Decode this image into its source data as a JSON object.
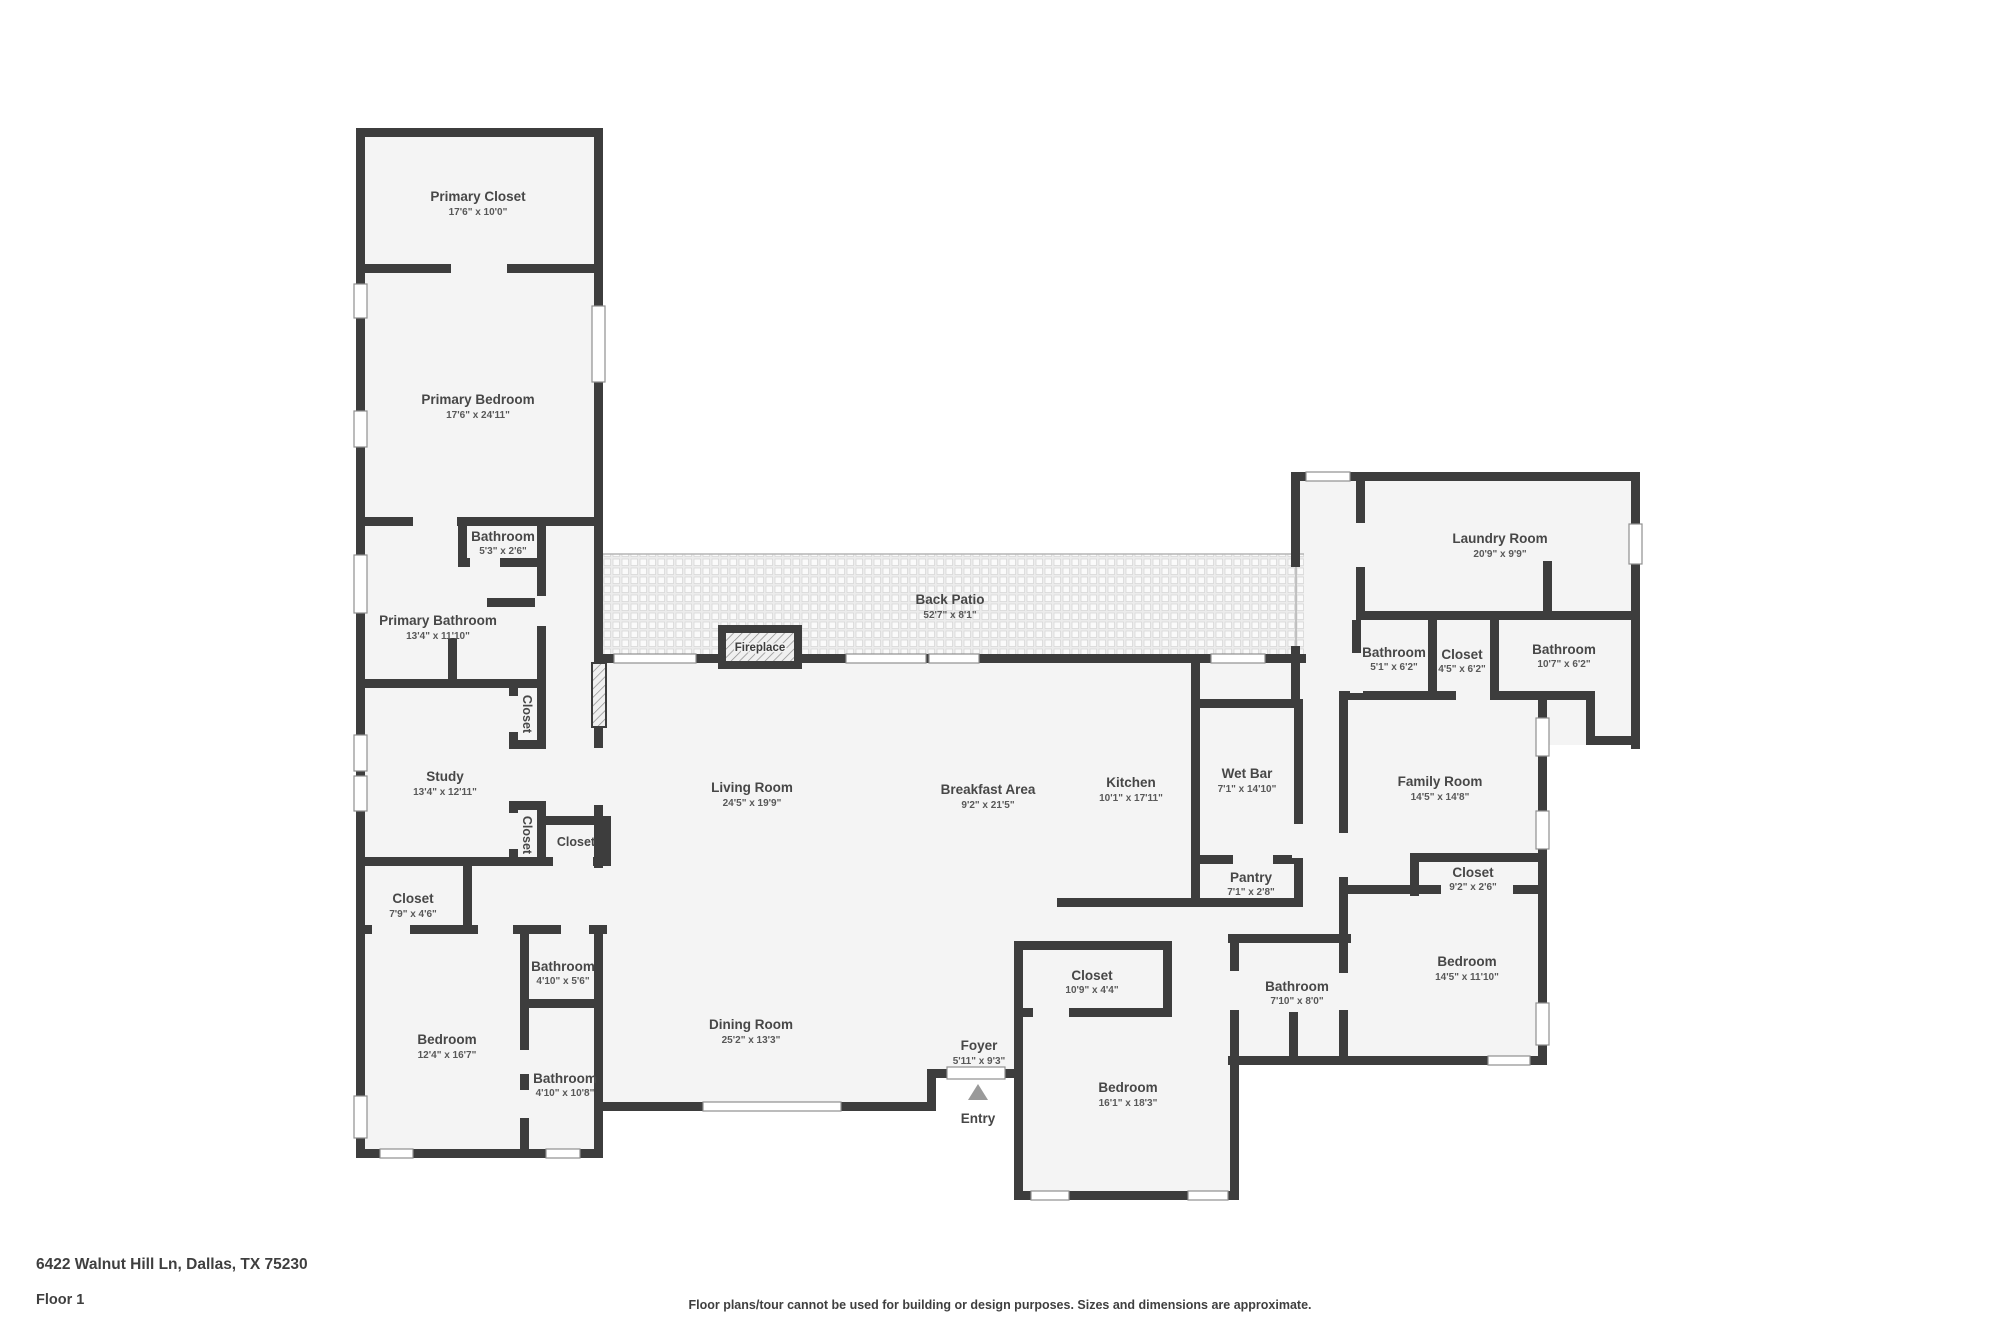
{
  "footer": {
    "address": "6422 Walnut Hill Ln, Dallas, TX 75230",
    "floor_label": "Floor 1",
    "disclaimer": "Floor plans/tour cannot be used for building or design purposes. Sizes and dimensions are approximate."
  },
  "markers": {
    "entry_label": "Entry",
    "fireplace_label": "Fireplace"
  },
  "colors": {
    "wall": "#3d3d3d",
    "room_fill": "#f4f4f4",
    "label_text": "#474747"
  },
  "rooms": {
    "primary_closet": {
      "name": "Primary Closet",
      "dims": "17'6\" x 10'0\""
    },
    "primary_bedroom": {
      "name": "Primary Bedroom",
      "dims": "17'6\" x 24'11\""
    },
    "bathroom_primary_small": {
      "name": "Bathroom",
      "dims": "5'3\" x 2'6\""
    },
    "primary_bathroom": {
      "name": "Primary Bathroom",
      "dims": "13'4\" x 11'10\""
    },
    "study": {
      "name": "Study",
      "dims": "13'4\" x 12'11\""
    },
    "closet_study_upper": {
      "name": "Closet",
      "dims": ""
    },
    "closet_study_lower": {
      "name": "Closet",
      "dims": ""
    },
    "closet_study_side": {
      "name": "Closet",
      "dims": ""
    },
    "closet_hall": {
      "name": "Closet",
      "dims": "7'9\" x 4'6\""
    },
    "bedroom_left": {
      "name": "Bedroom",
      "dims": "12'4\" x 16'7\""
    },
    "bathroom_left_upper": {
      "name": "Bathroom",
      "dims": "4'10\" x 5'6\""
    },
    "bathroom_left_lower": {
      "name": "Bathroom",
      "dims": "4'10\" x 10'8\""
    },
    "back_patio": {
      "name": "Back Patio",
      "dims": "52'7\" x 8'1\""
    },
    "living_room": {
      "name": "Living Room",
      "dims": "24'5\" x 19'9\""
    },
    "breakfast_area": {
      "name": "Breakfast Area",
      "dims": "9'2\" x 21'5\""
    },
    "kitchen": {
      "name": "Kitchen",
      "dims": "10'1\" x 17'11\""
    },
    "wet_bar": {
      "name": "Wet Bar",
      "dims": "7'1\" x 14'10\""
    },
    "pantry": {
      "name": "Pantry",
      "dims": "7'1\" x 2'8\""
    },
    "dining_room": {
      "name": "Dining Room",
      "dims": "25'2\" x 13'3\""
    },
    "foyer": {
      "name": "Foyer",
      "dims": "5'11\" x 9'3\""
    },
    "laundry_room": {
      "name": "Laundry Room",
      "dims": "20'9\" x 9'9\""
    },
    "bathroom_right_1": {
      "name": "Bathroom",
      "dims": "5'1\" x 6'2\""
    },
    "closet_right_1": {
      "name": "Closet",
      "dims": "4'5\" x 6'2\""
    },
    "bathroom_right_2": {
      "name": "Bathroom",
      "dims": "10'7\" x 6'2\""
    },
    "family_room": {
      "name": "Family Room",
      "dims": "14'5\" x 14'8\""
    },
    "closet_family": {
      "name": "Closet",
      "dims": "9'2\" x 2'6\""
    },
    "bedroom_right": {
      "name": "Bedroom",
      "dims": "14'5\" x 11'10\""
    },
    "bathroom_hall": {
      "name": "Bathroom",
      "dims": "7'10\" x 8'0\""
    },
    "closet_bedroom_center": {
      "name": "Closet",
      "dims": "10'9\" x 4'4\""
    },
    "bedroom_center": {
      "name": "Bedroom",
      "dims": "16'1\" x 18'3\""
    }
  }
}
